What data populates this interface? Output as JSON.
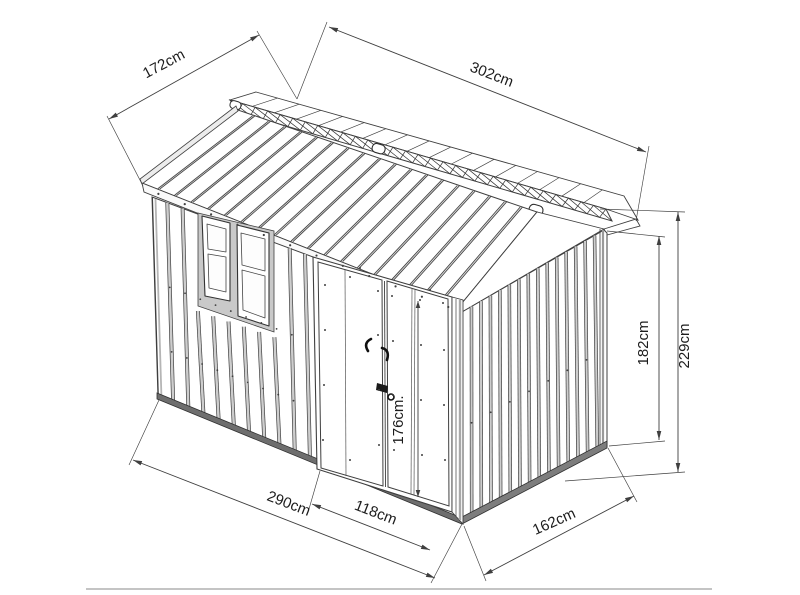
{
  "figure": {
    "kind": "isometric technical line drawing",
    "subject": "metal garden shed with double doors, side window and gabled roof",
    "line_color": "#3f3f3f",
    "shading_color": "#c9c9c9",
    "rail_color": "#6e6e6e",
    "background": "#ffffff"
  },
  "dimensions": {
    "roof_slope_width": {
      "label": "172cm"
    },
    "roof_length": {
      "label": "302cm"
    },
    "front_width": {
      "label": "290cm"
    },
    "door_width": {
      "label": "118cm"
    },
    "side_depth": {
      "label": "162cm"
    },
    "wall_height": {
      "label": "182cm"
    },
    "overall_height": {
      "label": "229cm"
    },
    "door_height": {
      "label": "176cm."
    }
  }
}
